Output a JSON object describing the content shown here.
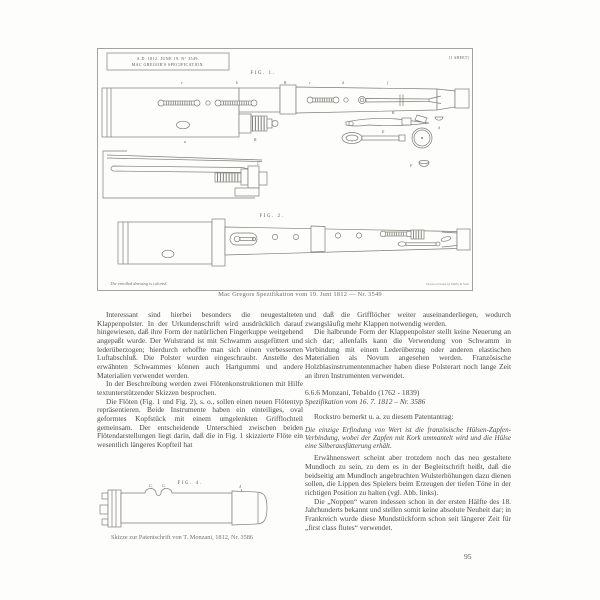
{
  "colors": {
    "ink": "#4a4943",
    "drawing_line": "#7e7d75",
    "caption": "#6f6e67",
    "page_bg": "#fdfdfb"
  },
  "page": {
    "number": "95"
  },
  "plate": {
    "header_line1": "A.D. 1812. JUNE 19. N° 3549.",
    "header_line2": "MAC GREGOR'S SPECIFICATION.",
    "sheet_note": "[1 SHEET]",
    "fig1_label": "FIG. 1.",
    "fig2_label": "FIG. 2.",
    "note_left": "The enrolled drawing is colored.",
    "note_right": "Drawn on Stone by Malby & Sons",
    "caption": "Mac Gregors Spezifikation vom 19. Juni 1812 — Nr. 3549",
    "fig1_marks": [
      "e",
      "b",
      "B",
      "c",
      "d",
      "f"
    ],
    "part_labels": {
      "a": "a",
      "tenon": "B",
      "rod": "C",
      "lever": "B",
      "key": "E",
      "pad": "d",
      "cup": "F"
    }
  },
  "fig4": {
    "label": "FIG. 4.",
    "marks": {
      "g1": "G.",
      "g2": "G.",
      "a": "A"
    },
    "caption": "Skizze zur Patentschrift von T. Monzani, 1812, Nr. 3586"
  },
  "left_column": {
    "p1": "Interessant sind hierbei besonders die neugestalteten Klappenpolster. In der Urkundenschrift wird ausdrücklich darauf hingewiesen, daß ihre Form der natürlichen Fingerkuppe weitgehend angepaßt wurde. Der Wulstrand ist mit Schwamm ausgefüttert und lederüberzogen; hierdurch erhoffte man sich einen verbesserten Luftabschluß. Die Polster wurden eingeschraubt. Anstelle des erwähnten Schwammes können auch Hartgummi und andere Materialien verwendet werden.",
    "p2": "In der Beschreibung werden zwei Flötenkonstruktionen mit Hilfe textunterstützender Skizzen besprochen.",
    "p3": "Die Flöten (Fig. 1 und Fig. 2), s. o., sollen einen neuen Flötentyp repräsentieren. Beide Instrumente haben ein einteiliges, oval geformtes Kopfstück mit einem umgelenkten Grifflochteil gemeinsam. Der entscheidende Unterschied zwischen beiden Flötendarstellungen liegt darin, daß die in Fig. 1 skizzierte Flöte ein wesentlich längeres Kopfteil hat"
  },
  "right_column": {
    "p1": "und daß die Grifflöcher weiter auseinanderliegen, wodurch zwangsläufig mehr Klappen notwendig werden.",
    "p2": "Die halbrunde Form der Klappenpolster stellt keine Neuerung an sich dar; allenfalls kann die Verwendung von Schwamm in Verbindung mit einem Lederüberzug oder anderen elastischen Materialien als Novum angesehen werden. Französische Holzblasinstrumentenmacher haben diese Polsterart noch lange Zeit an ihren Instrumenten verwendet.",
    "heading": "6.6.6 Monzani, Tebaldo (1762 - 1839)",
    "spec": "Spezifikation vom 16. 7. 1812 – Nr. 3586",
    "intro": "Rockstro bemerkt u. a. zu diesem Patentantrag:",
    "quote": "Die einzige Erfindung von Wert ist die französische Hülsen-Zapfen-Verbindung, wobei der Zapfen mit Kork ummantelt wird und die Hülse eine Silberausfütterung erhält.",
    "p3": "Erwähnenswert scheint aber trotzdem noch das neu gestaltete Mundloch zu sein, zu dem es in der Begleitschrift heißt, daß die beidseitig am Mundloch angebrachten Wulsterhöhungen dazu dienen sollen, die Lippen des Spielers beim Erzeugen der tiefen Töne in der richtigen Position zu halten (vgl. Abb. links).",
    "p4": "Die „Noppen“ waren indessen schon in der ersten Hälfte des 18. Jahrhunderts bekannt und stellen somit keine absolute Neuheit dar; in Frankreich wurde diese Mundstückform schon seit längerer Zeit für „first class flutes“ verwendet."
  }
}
